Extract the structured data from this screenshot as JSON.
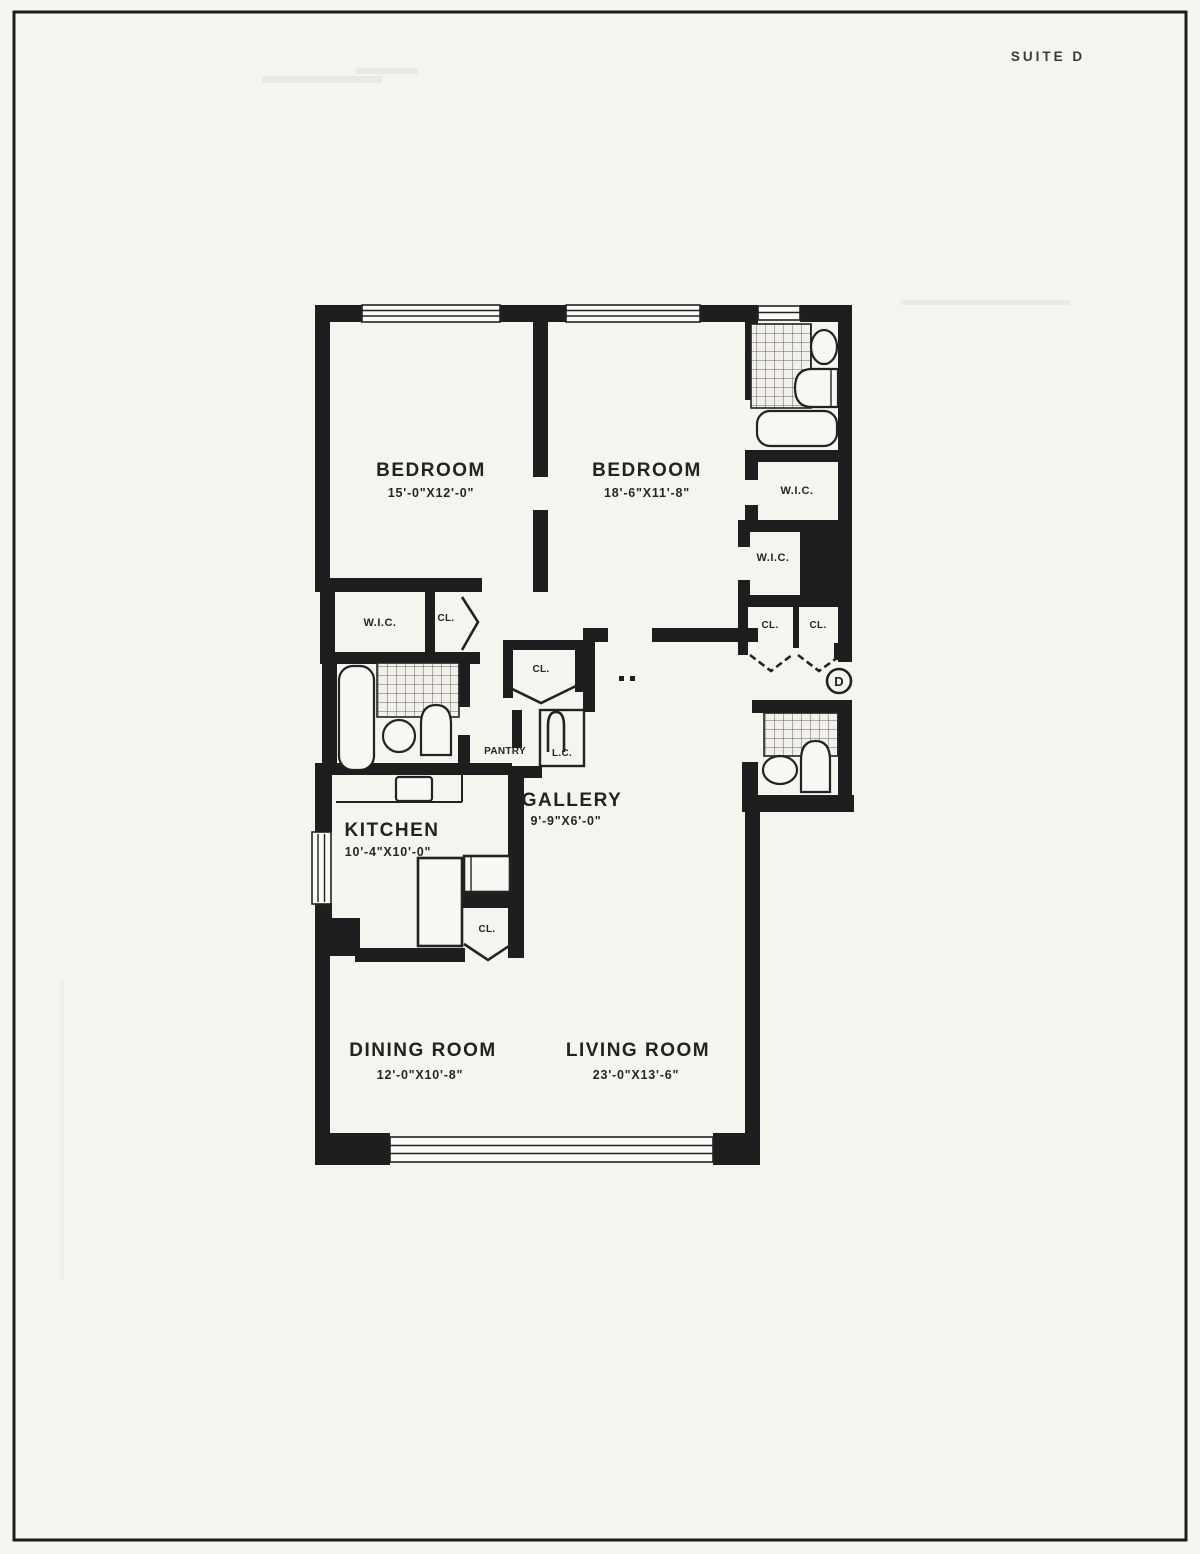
{
  "page": {
    "suite_label": "SUITE D"
  },
  "colors": {
    "ink": "#1e1e1e",
    "paper": "#f5f4ef"
  },
  "rooms": {
    "bedroom_left": {
      "name": "BEDROOM",
      "dims": "15'-0\"X12'-0\""
    },
    "bedroom_right": {
      "name": "BEDROOM",
      "dims": "18'-6\"X11'-8\""
    },
    "gallery": {
      "name": "GALLERY",
      "dims": "9'-9\"X6'-0\""
    },
    "kitchen": {
      "name": "KITCHEN",
      "dims": "10'-4\"X10'-0\""
    },
    "dining_room": {
      "name": "DINING ROOM",
      "dims": "12'-0\"X10'-8\""
    },
    "living_room": {
      "name": "LIVING ROOM",
      "dims": "23'-0\"X13'-6\""
    }
  },
  "closets": {
    "wic_left": "W.I.C.",
    "wic_right_upper": "W.I.C.",
    "wic_right_lower": "W.I.C.",
    "cl_left": "CL.",
    "cl_hall": "CL.",
    "cl_entry_left": "CL.",
    "cl_entry_right": "CL.",
    "cl_kitchen": "CL.",
    "pantry": "PANTRY",
    "linen_closet": "L.C."
  },
  "entry": {
    "door_label": "D"
  }
}
